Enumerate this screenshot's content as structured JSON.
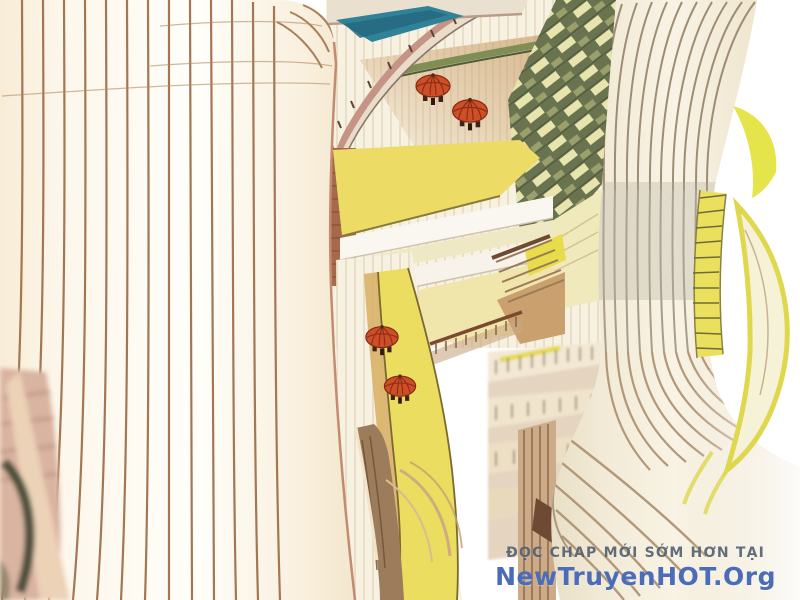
{
  "watermark": {
    "line1": "ĐỌC CHAP MỚI SỚM HƠN TẠI",
    "line2": "NewTruyenHOT.Org"
  },
  "scene": {
    "description": "Aerial concept-art view of a curved multi-level mall atrium: two ribbed cream towers framing terraces, yellow walkways, a louvered green glass facade, curved bridges and café umbrellas",
    "objects": {
      "towers": 2,
      "umbrellas": 4,
      "bridges": 2,
      "terrace_levels": 5
    },
    "palette": {
      "background": "#ffffff",
      "tower_cream": "#fbf4e6",
      "tower_stripe": "#9c6b45",
      "bridge_rose": "#c59486",
      "teal_ramp": "#2f8298",
      "terrace_wood": "#d8b890",
      "louver_green": "#6a7350",
      "louver_highlight": "#e7e4ae",
      "atrium_yellow": "#eadd5f",
      "accent_yellow": "#ebe05e",
      "ribbon_yellow_green": "#e4e441",
      "umbrella_red": "#ce4e27",
      "ramp_brown": "#9d7c5b",
      "watermark_gray": "#4d5a6b",
      "watermark_blue": "#4b6cb8"
    }
  }
}
